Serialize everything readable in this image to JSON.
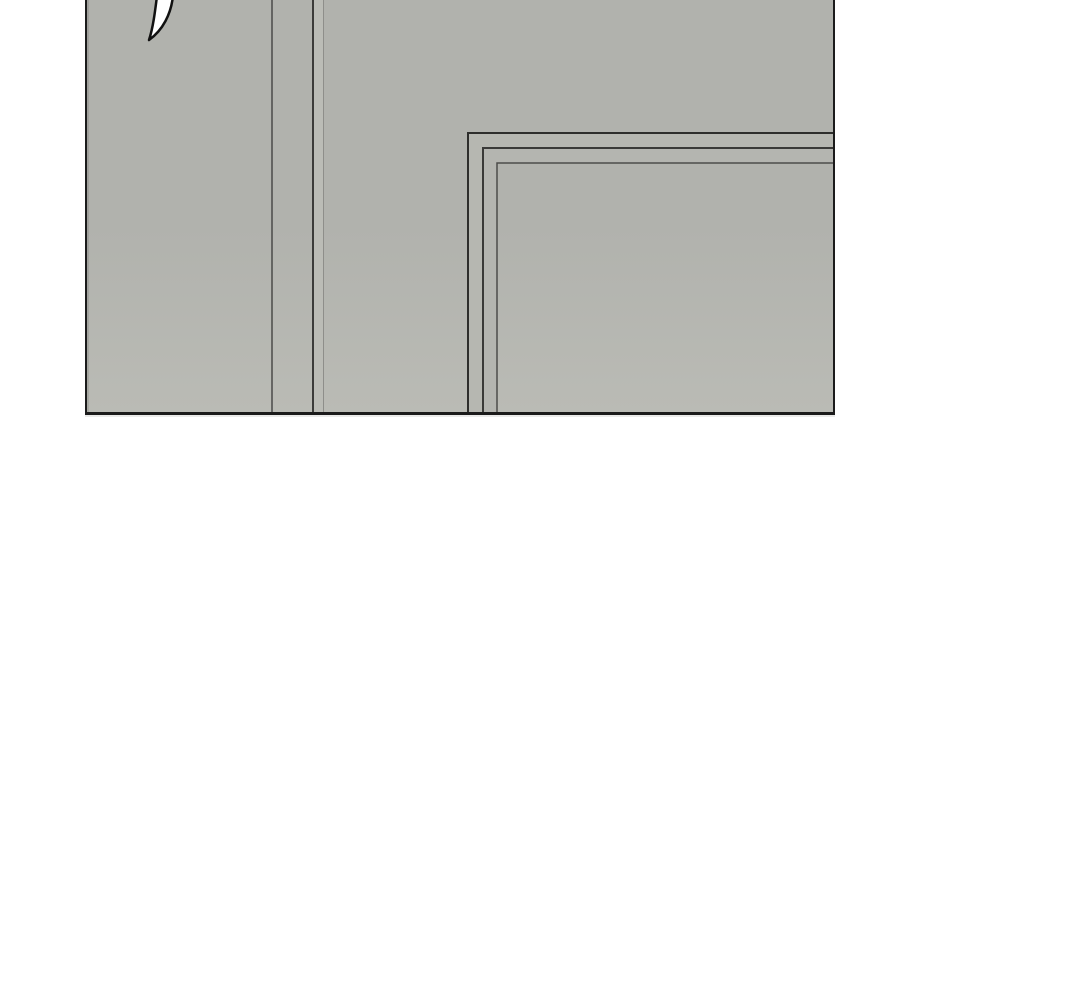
{
  "page": {
    "background_color": "#ffffff"
  },
  "panel": {
    "type": "comic-panel",
    "description": "Gray interior scene panel cropped at top edge; wall corner lines at left-center, nested door/picture frame corner at right, tapering brush stroke at top-left",
    "border_color": "#1b1b1b",
    "fill_top_color": "#b1b2ad",
    "fill_bottom_color": "#babbb5",
    "under_shadow_color": "#d9d9d7",
    "artwork": {
      "brush_stroke": {
        "fill_color": "#ffffff",
        "outline_color": "#111111"
      },
      "wall_lines": {
        "line_a_color": "#4b4b49",
        "line_b_color": "#3c3c3a",
        "line_c_color": "#8e8e8a",
        "highlight_strip_color": "#bbbcb6"
      },
      "door_frame": {
        "outer_line_color": "#2e2e2c",
        "middle_line_color": "#3a3a38",
        "inner_line_color": "#4c4c4a",
        "band_1_color": "#b6b7b1",
        "band_2_color": "#b4b5b0"
      }
    }
  }
}
